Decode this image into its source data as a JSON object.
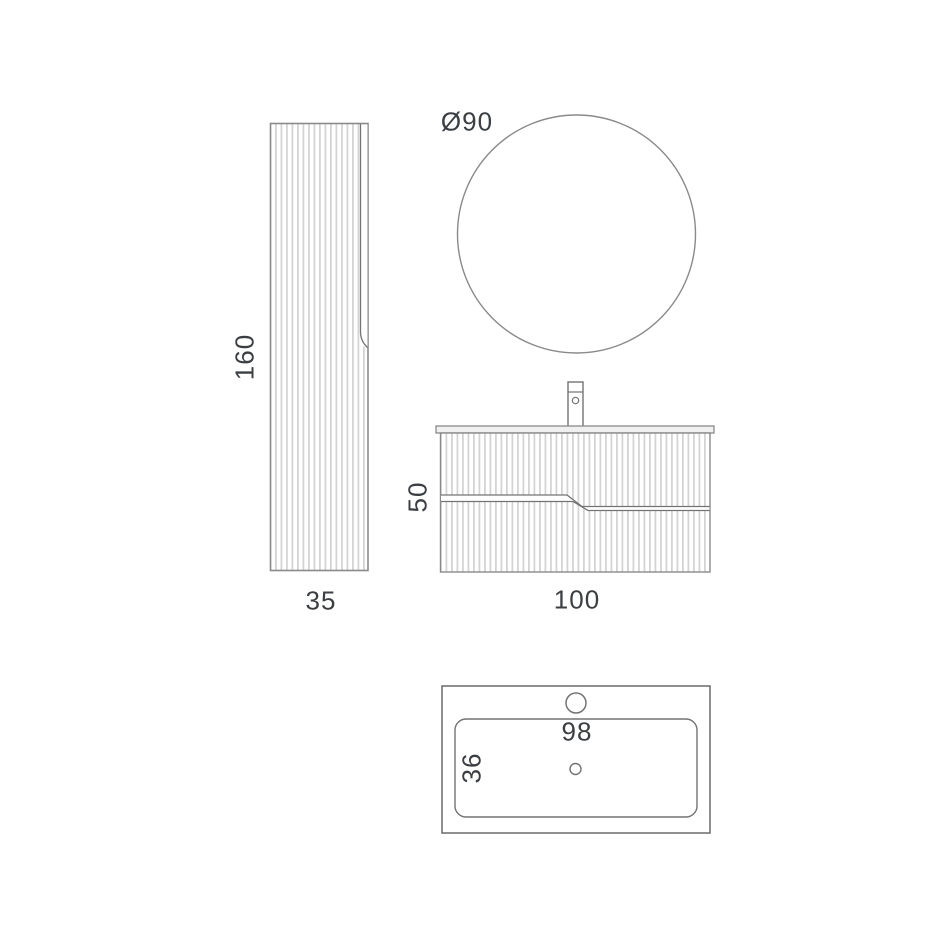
{
  "canvas": {
    "background": "#ffffff",
    "line_color": "#8a8a8a",
    "gap_line_color": "#737373",
    "flute_color": "#d4d4d4",
    "text_color": "#3b3e42"
  },
  "views": {
    "tall_cabinet": {
      "description": "fluted tall side cabinet, front elevation",
      "height_label": "160",
      "width_label": "35"
    },
    "mirror": {
      "description": "round mirror, front view",
      "diameter_label": "Ø90"
    },
    "vanity": {
      "description": "fluted wall-hung vanity unit with basin tap, front elevation",
      "height_label": "50",
      "width_label": "100"
    },
    "basin_top_view": {
      "description": "washbasin countertop, plan view",
      "width_label": "98",
      "depth_label": "36"
    }
  }
}
